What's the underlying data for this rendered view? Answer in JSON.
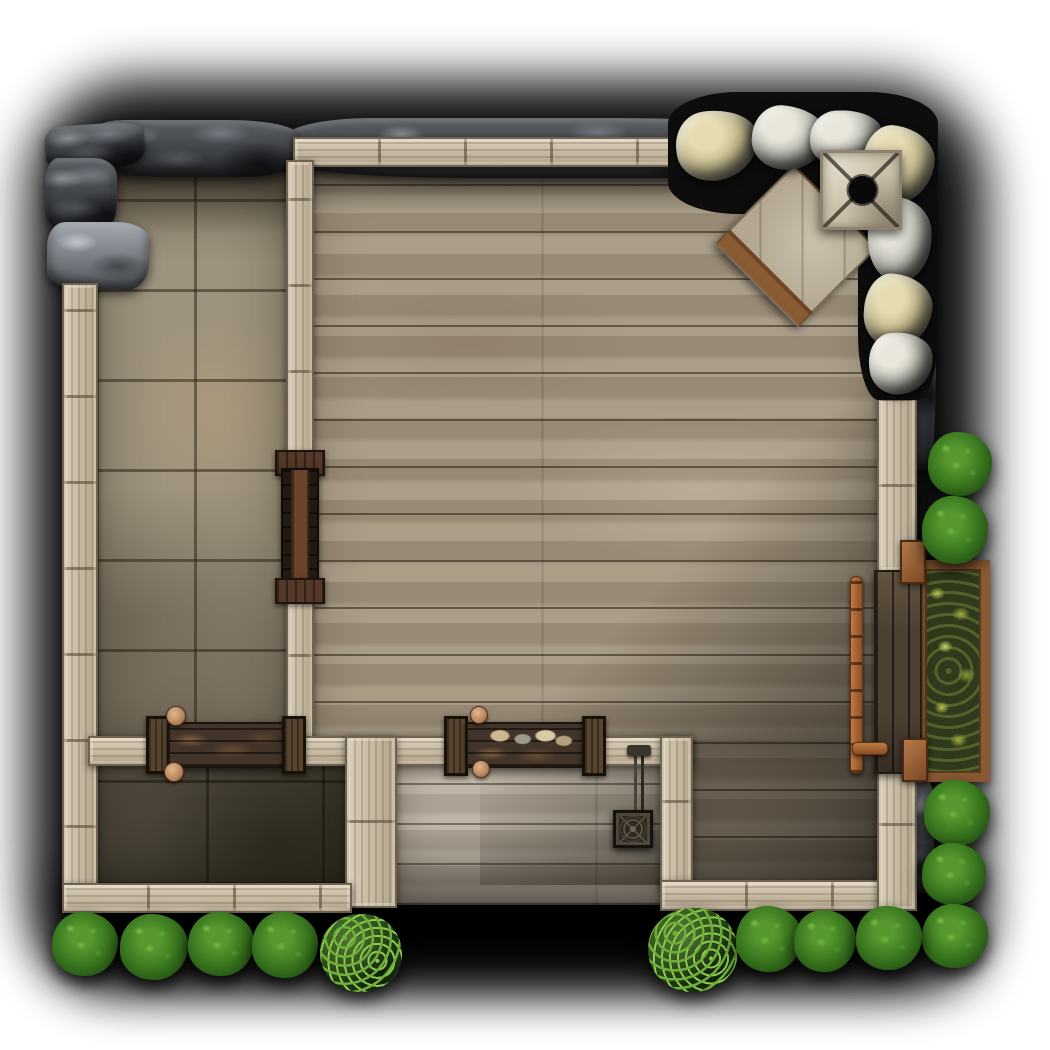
{
  "scene": {
    "title": "Top-down fantasy battle map: timber house with stone-floored room, wooden hall, entry porch, rock outcrops, chimney, counters, garden planter and bushes",
    "canvas": {
      "width": 1050,
      "height": 1050,
      "background": "#ffffff",
      "shadow_color": "#000000"
    },
    "palette": {
      "wall_wood": "#c7baa3",
      "wall_edge": "#6e6250",
      "floor_wood": "#a2947f",
      "floor_porch": "#b7ad9e",
      "floor_stone": "#9e937e",
      "floor_stone_dark": "#716a5a",
      "cliff_rock": "#45484c",
      "boulder_light": "#b8b8af",
      "boulder_tan": "#c3b88c",
      "chimney_stone": "#cbc2ac",
      "counter_wood": "#43342a",
      "door_wood": "#6b432c",
      "copper_rail": "#b06a35",
      "planter_frame": "#8a5a33",
      "foliage_dark": "#245314",
      "foliage_light": "#9fae3f",
      "mug_clay": "#c59674"
    },
    "objects": [
      {
        "name": "map-drop-shadow",
        "type": "shadow-blob",
        "x": 28,
        "y": 80,
        "w": 958,
        "h": 900,
        "z": 0,
        "interactable": false
      },
      {
        "name": "map-drop-shadow-south",
        "type": "shadow-blob",
        "x": 42,
        "y": 870,
        "w": 940,
        "h": 118,
        "z": 0,
        "interactable": false
      },
      {
        "name": "stone-room-floor",
        "type": "floor-stone",
        "x": 96,
        "y": 172,
        "w": 194,
        "h": 570,
        "z": 1,
        "interactable": false
      },
      {
        "name": "great-hall-wood-floor",
        "type": "floor-wood",
        "x": 305,
        "y": 165,
        "w": 580,
        "h": 585,
        "z": 1,
        "interactable": false
      },
      {
        "name": "hall-wood-floor-south",
        "type": "floor-wood",
        "x": 680,
        "y": 740,
        "w": 205,
        "h": 145,
        "z": 1,
        "interactable": false
      },
      {
        "name": "storeroom-stone-floor",
        "type": "floor-stone-dark",
        "x": 90,
        "y": 740,
        "w": 265,
        "h": 145,
        "z": 1,
        "interactable": false
      },
      {
        "name": "porch-floor",
        "type": "floor-wood-porch",
        "x": 395,
        "y": 742,
        "w": 270,
        "h": 163,
        "z": 1,
        "interactable": false
      },
      {
        "name": "stone-room-top-shade",
        "type": "overlay-top-shade",
        "x": 96,
        "y": 172,
        "w": 194,
        "h": 62,
        "z": 2,
        "interactable": false
      },
      {
        "name": "hall-top-shade",
        "type": "overlay-top-shade",
        "x": 305,
        "y": 165,
        "w": 580,
        "h": 48,
        "z": 2,
        "interactable": false
      },
      {
        "name": "hall-corner-shade",
        "type": "overlay-br-shade",
        "x": 480,
        "y": 380,
        "w": 405,
        "h": 505,
        "z": 2,
        "interactable": false
      },
      {
        "name": "storeroom-shade",
        "type": "overlay-tint-dark",
        "x": 90,
        "y": 740,
        "w": 265,
        "h": 145,
        "z": 2,
        "interactable": false
      },
      {
        "name": "porch-bottom-shade",
        "type": "overlay-bottom-shade",
        "x": 395,
        "y": 828,
        "w": 270,
        "h": 77,
        "z": 2,
        "interactable": false
      },
      {
        "name": "cliff-strip-north",
        "type": "rock-dark",
        "x": 283,
        "y": 118,
        "w": 492,
        "h": 60,
        "z": 3,
        "interactable": false
      },
      {
        "name": "cliff-bar-northwest",
        "type": "rock-dark",
        "x": 85,
        "y": 120,
        "w": 212,
        "h": 57,
        "z": 3,
        "interactable": false
      },
      {
        "name": "cliff-corner-slab",
        "type": "rock-dark",
        "x": 45,
        "y": 124,
        "w": 100,
        "h": 44,
        "z": 3,
        "rot": -4,
        "interactable": false
      },
      {
        "name": "cliff-west-upper",
        "type": "rock-dark",
        "x": 45,
        "y": 158,
        "w": 72,
        "h": 74,
        "z": 3,
        "interactable": false
      },
      {
        "name": "cliff-west-lower",
        "type": "rock-mid",
        "x": 47,
        "y": 222,
        "w": 102,
        "h": 68,
        "z": 3,
        "interactable": false
      },
      {
        "name": "cliff-strip-east",
        "type": "rock-dark",
        "x": 908,
        "y": 160,
        "w": 28,
        "h": 310,
        "z": 3,
        "interactable": false
      },
      {
        "name": "cliff-piece-southeast",
        "type": "rock-dark",
        "x": 898,
        "y": 775,
        "w": 36,
        "h": 118,
        "z": 3,
        "interactable": false
      },
      {
        "name": "wall-north",
        "type": "wall-h",
        "x": 293,
        "y": 137,
        "w": 614,
        "h": 30,
        "z": 4,
        "interactable": false
      },
      {
        "name": "wall-west",
        "type": "wall-v",
        "x": 62,
        "y": 283,
        "w": 36,
        "h": 630,
        "z": 4,
        "interactable": false
      },
      {
        "name": "wall-divider-upper",
        "type": "wall-v",
        "x": 286,
        "y": 160,
        "w": 28,
        "h": 298,
        "z": 4,
        "interactable": false
      },
      {
        "name": "wall-divider-lower",
        "type": "wall-v",
        "x": 286,
        "y": 596,
        "w": 28,
        "h": 146,
        "z": 4,
        "interactable": false
      },
      {
        "name": "wall-inner-west",
        "type": "wall-h",
        "x": 88,
        "y": 736,
        "w": 64,
        "h": 30,
        "z": 4,
        "interactable": false
      },
      {
        "name": "wall-inner-mid",
        "type": "wall-h",
        "x": 298,
        "y": 736,
        "w": 152,
        "h": 30,
        "z": 4,
        "interactable": false
      },
      {
        "name": "wall-inner-east",
        "type": "wall-h",
        "x": 598,
        "y": 736,
        "w": 95,
        "h": 30,
        "z": 4,
        "interactable": false
      },
      {
        "name": "wall-storeroom-east",
        "type": "wall-v",
        "x": 345,
        "y": 736,
        "w": 52,
        "h": 172,
        "z": 4,
        "interactable": false
      },
      {
        "name": "wall-porch-east",
        "type": "wall-v",
        "x": 660,
        "y": 736,
        "w": 33,
        "h": 152,
        "z": 4,
        "interactable": false
      },
      {
        "name": "wall-south-west",
        "type": "wall-h",
        "x": 62,
        "y": 883,
        "w": 290,
        "h": 30,
        "z": 4,
        "interactable": false
      },
      {
        "name": "wall-south-east",
        "type": "wall-h",
        "x": 660,
        "y": 880,
        "w": 257,
        "h": 31,
        "z": 4,
        "interactable": false
      },
      {
        "name": "wall-east-upper",
        "type": "wall-v",
        "x": 877,
        "y": 140,
        "w": 40,
        "h": 432,
        "z": 4,
        "interactable": false
      },
      {
        "name": "wall-east-lower",
        "type": "wall-v",
        "x": 877,
        "y": 770,
        "w": 40,
        "h": 141,
        "z": 4,
        "interactable": false
      },
      {
        "name": "boulder-pile-backing",
        "type": "rock-backing",
        "x": 668,
        "y": 92,
        "w": 270,
        "h": 122,
        "z": 5,
        "interactable": false
      },
      {
        "name": "boulder-column-backing",
        "type": "rock-backing",
        "x": 858,
        "y": 148,
        "w": 80,
        "h": 252,
        "z": 5,
        "interactable": false
      },
      {
        "name": "counter-west-post-left",
        "type": "counter-post",
        "x": 146,
        "y": 716,
        "w": 24,
        "h": 58,
        "z": 5,
        "interactable": true
      },
      {
        "name": "counter-west-top",
        "type": "counter-body",
        "x": 168,
        "y": 722,
        "w": 116,
        "h": 46,
        "z": 5,
        "interactable": true
      },
      {
        "name": "counter-west-post-right",
        "type": "counter-post",
        "x": 282,
        "y": 716,
        "w": 24,
        "h": 58,
        "z": 5,
        "interactable": true
      },
      {
        "name": "counter-porch-post-left",
        "type": "counter-post",
        "x": 444,
        "y": 716,
        "w": 24,
        "h": 60,
        "z": 5,
        "interactable": true
      },
      {
        "name": "counter-porch-top",
        "type": "counter-body-items",
        "x": 466,
        "y": 722,
        "w": 118,
        "h": 46,
        "z": 5,
        "interactable": true
      },
      {
        "name": "counter-porch-post-right",
        "type": "counter-post",
        "x": 582,
        "y": 716,
        "w": 24,
        "h": 60,
        "z": 5,
        "interactable": true
      },
      {
        "name": "door-north-cap",
        "type": "door-cap",
        "x": 275,
        "y": 450,
        "w": 50,
        "h": 26,
        "z": 5,
        "interactable": true
      },
      {
        "name": "door-body",
        "type": "door-body",
        "x": 281,
        "y": 468,
        "w": 38,
        "h": 118,
        "z": 5,
        "interactable": true
      },
      {
        "name": "door-south-cap",
        "type": "door-cap",
        "x": 275,
        "y": 578,
        "w": 50,
        "h": 26,
        "z": 5,
        "interactable": true
      },
      {
        "name": "hanging-sign-bracket",
        "type": "sign-bracket",
        "x": 630,
        "y": 752,
        "w": 18,
        "h": 64,
        "z": 5,
        "interactable": true
      },
      {
        "name": "hanging-sign-plaque",
        "type": "sign-plaque",
        "x": 613,
        "y": 810,
        "w": 40,
        "h": 38,
        "z": 5,
        "interactable": true
      },
      {
        "name": "garden-planter-box",
        "type": "planter-box",
        "x": 916,
        "y": 560,
        "w": 74,
        "h": 222,
        "z": 5,
        "interactable": true
      },
      {
        "name": "wall-bench-east",
        "type": "bench-planks",
        "x": 874,
        "y": 570,
        "w": 48,
        "h": 204,
        "z": 5,
        "interactable": true
      },
      {
        "name": "bench-post-north",
        "type": "post-brown",
        "x": 900,
        "y": 540,
        "w": 26,
        "h": 44,
        "z": 6,
        "interactable": true
      },
      {
        "name": "bench-post-south",
        "type": "post-brown",
        "x": 902,
        "y": 738,
        "w": 26,
        "h": 44,
        "z": 6,
        "interactable": true
      },
      {
        "name": "bench-copper-rail",
        "type": "rail-copper",
        "x": 850,
        "y": 576,
        "w": 13,
        "h": 198,
        "z": 6,
        "interactable": true
      },
      {
        "name": "bench-copper-elbow",
        "type": "elbow-copper",
        "x": 852,
        "y": 742,
        "w": 36,
        "h": 13,
        "z": 6,
        "interactable": true
      },
      {
        "name": "mug-counter-west-north",
        "type": "mug",
        "x": 166,
        "y": 706,
        "w": 20,
        "h": 20,
        "z": 6,
        "interactable": true
      },
      {
        "name": "mug-counter-west-south",
        "type": "mug",
        "x": 164,
        "y": 762,
        "w": 20,
        "h": 20,
        "z": 6,
        "interactable": true
      },
      {
        "name": "mug-counter-porch-north",
        "type": "mug",
        "x": 470,
        "y": 706,
        "w": 18,
        "h": 18,
        "z": 6,
        "interactable": true
      },
      {
        "name": "mug-counter-porch-south",
        "type": "mug",
        "x": 472,
        "y": 760,
        "w": 18,
        "h": 18,
        "z": 6,
        "interactable": true
      },
      {
        "name": "stone-platform",
        "type": "platform-stone",
        "x": 737,
        "y": 190,
        "w": 118,
        "h": 112,
        "z": 6,
        "rot": 45,
        "interactable": true
      },
      {
        "name": "boulder-nw",
        "type": "boulder-tan",
        "x": 676,
        "y": 110,
        "w": 82,
        "h": 70,
        "z": 6,
        "rot": -8,
        "interactable": true
      },
      {
        "name": "boulder-n1",
        "type": "boulder",
        "x": 752,
        "y": 106,
        "w": 74,
        "h": 64,
        "z": 6,
        "rot": 5,
        "interactable": true
      },
      {
        "name": "boulder-n2",
        "type": "boulder",
        "x": 810,
        "y": 110,
        "w": 72,
        "h": 56,
        "z": 6,
        "rot": -4,
        "interactable": true
      },
      {
        "name": "boulder-ne",
        "type": "boulder-tan",
        "x": 862,
        "y": 126,
        "w": 72,
        "h": 78,
        "z": 6,
        "rot": 6,
        "interactable": true
      },
      {
        "name": "boulder-e1",
        "type": "boulder",
        "x": 868,
        "y": 196,
        "w": 64,
        "h": 86,
        "z": 6,
        "rot": -5,
        "interactable": true
      },
      {
        "name": "boulder-e2",
        "type": "boulder-tan",
        "x": 864,
        "y": 274,
        "w": 68,
        "h": 74,
        "z": 6,
        "rot": 4,
        "interactable": true
      },
      {
        "name": "boulder-e3",
        "type": "boulder",
        "x": 869,
        "y": 332,
        "w": 64,
        "h": 62,
        "z": 6,
        "rot": -7,
        "interactable": true
      },
      {
        "name": "chimney-top",
        "type": "chimney",
        "x": 820,
        "y": 150,
        "w": 82,
        "h": 80,
        "z": 7,
        "interactable": true
      },
      {
        "name": "bush-northeast-1",
        "type": "bush-spiky",
        "x": 928,
        "y": 432,
        "w": 64,
        "h": 64,
        "z": 8,
        "interactable": true
      },
      {
        "name": "bush-northeast-2",
        "type": "bush-spiky",
        "x": 922,
        "y": 496,
        "w": 66,
        "h": 68,
        "z": 8,
        "interactable": true
      },
      {
        "name": "bush-east-1",
        "type": "bush-spiky",
        "x": 924,
        "y": 780,
        "w": 66,
        "h": 66,
        "z": 8,
        "interactable": true
      },
      {
        "name": "bush-east-2",
        "type": "bush-spiky",
        "x": 922,
        "y": 843,
        "w": 64,
        "h": 62,
        "z": 8,
        "interactable": true
      },
      {
        "name": "bush-east-3",
        "type": "bush-spiky",
        "x": 922,
        "y": 904,
        "w": 66,
        "h": 64,
        "z": 8,
        "interactable": true
      },
      {
        "name": "bush-southwest-1",
        "type": "bush-spiky",
        "x": 52,
        "y": 912,
        "w": 66,
        "h": 64,
        "z": 8,
        "interactable": true
      },
      {
        "name": "bush-southwest-2",
        "type": "bush-spiky",
        "x": 120,
        "y": 914,
        "w": 68,
        "h": 66,
        "z": 8,
        "interactable": true
      },
      {
        "name": "bush-southwest-3",
        "type": "bush-spiky",
        "x": 188,
        "y": 912,
        "w": 66,
        "h": 64,
        "z": 8,
        "interactable": true
      },
      {
        "name": "bush-southwest-4",
        "type": "bush-spiky",
        "x": 252,
        "y": 912,
        "w": 66,
        "h": 66,
        "z": 8,
        "interactable": true
      },
      {
        "name": "bush-southwest-round",
        "type": "bush-round",
        "x": 320,
        "y": 914,
        "w": 82,
        "h": 78,
        "z": 8,
        "interactable": true
      },
      {
        "name": "bush-southeast-round",
        "type": "bush-round",
        "x": 648,
        "y": 908,
        "w": 90,
        "h": 84,
        "z": 8,
        "interactable": true
      },
      {
        "name": "bush-southeast-1",
        "type": "bush-spiky",
        "x": 736,
        "y": 906,
        "w": 66,
        "h": 66,
        "z": 8,
        "interactable": true
      },
      {
        "name": "bush-southeast-2",
        "type": "bush-spiky",
        "x": 794,
        "y": 910,
        "w": 62,
        "h": 62,
        "z": 8,
        "interactable": true
      },
      {
        "name": "bush-southeast-3",
        "type": "bush-spiky",
        "x": 856,
        "y": 906,
        "w": 66,
        "h": 64,
        "z": 8,
        "interactable": true
      }
    ]
  }
}
